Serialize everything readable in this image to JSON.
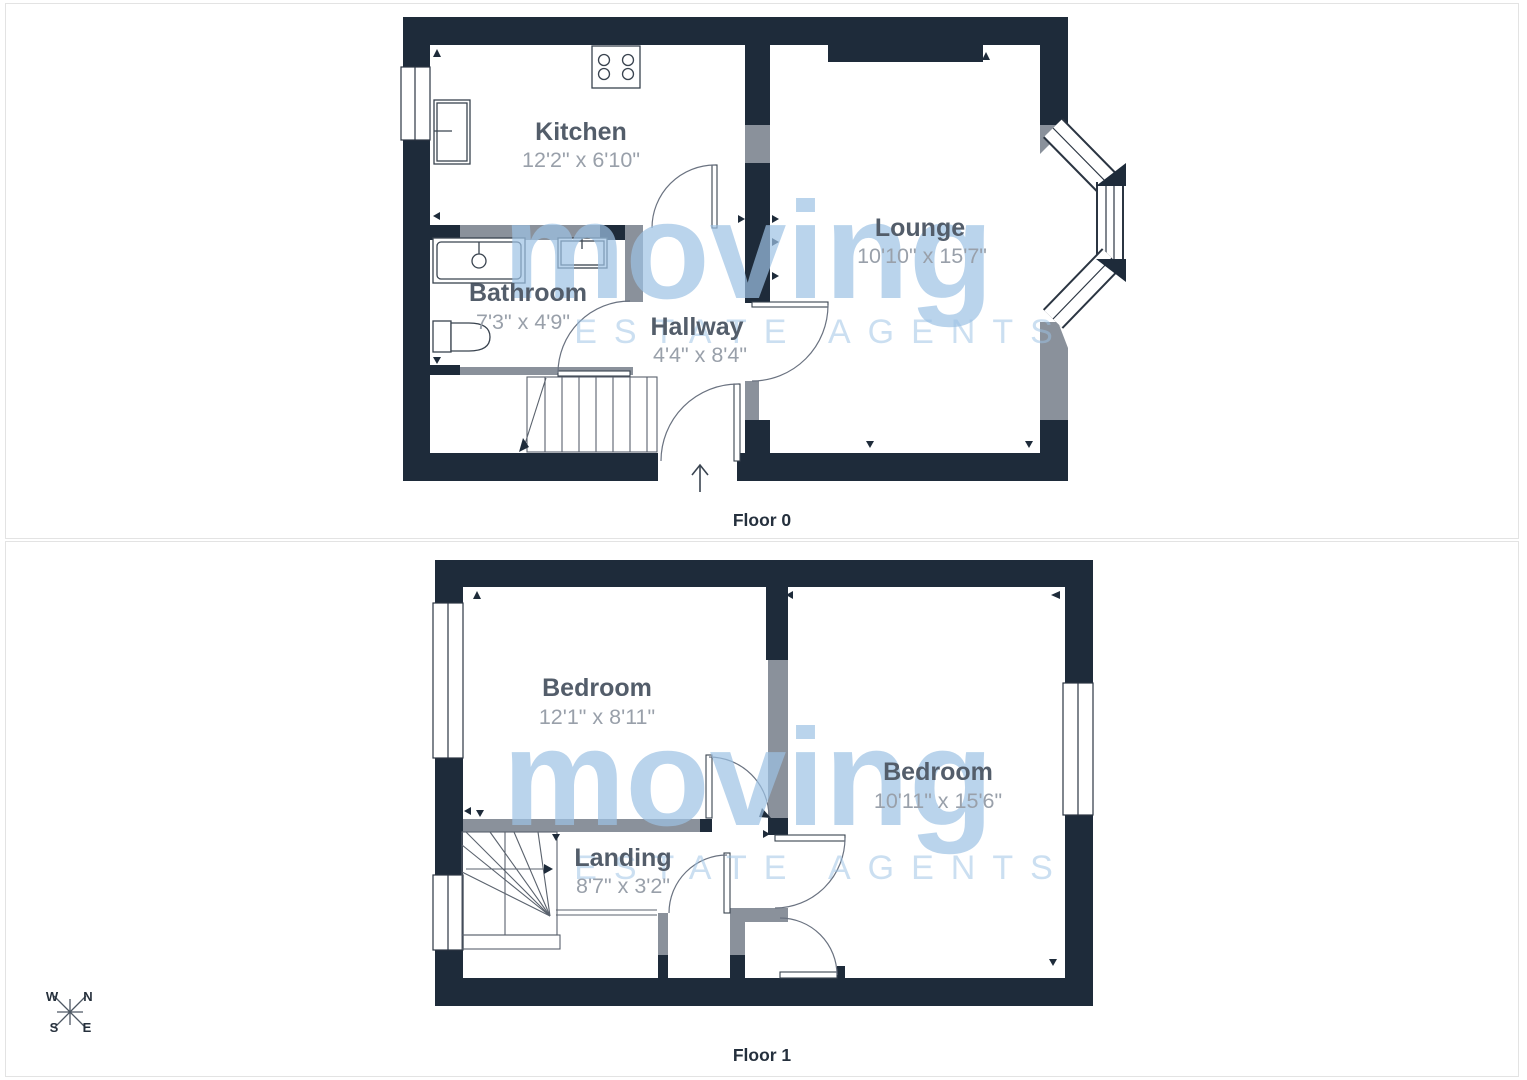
{
  "floors": [
    {
      "label": "Floor 0",
      "rooms": [
        {
          "name": "Kitchen",
          "dims": "12'2\" x 6'10\""
        },
        {
          "name": "Lounge",
          "dims": "10'10\" x 15'7\""
        },
        {
          "name": "Bathroom",
          "dims": "7'3\" x 4'9\""
        },
        {
          "name": "Hallway",
          "dims": "4'4\" x 8'4\""
        }
      ]
    },
    {
      "label": "Floor 1",
      "rooms": [
        {
          "name": "Bedroom",
          "dims": "12'1\" x 8'11\""
        },
        {
          "name": "Bedroom",
          "dims": "10'11\" x 15'6\""
        },
        {
          "name": "Landing",
          "dims": "8'7\" x 3'2\""
        }
      ]
    }
  ],
  "watermark": {
    "brand": "moving",
    "tagline": "ESTATE AGENTS"
  },
  "compass": {
    "top_left": "W",
    "top_right": "N",
    "bottom_left": "S",
    "bottom_right": "E"
  },
  "colors": {
    "wall": "#1e2b3a",
    "partition_wall": "#8a919b",
    "watermark_blue": "#9cc2e4",
    "room_name_text": "#535d6a",
    "room_dims_text": "#99a0aa"
  }
}
